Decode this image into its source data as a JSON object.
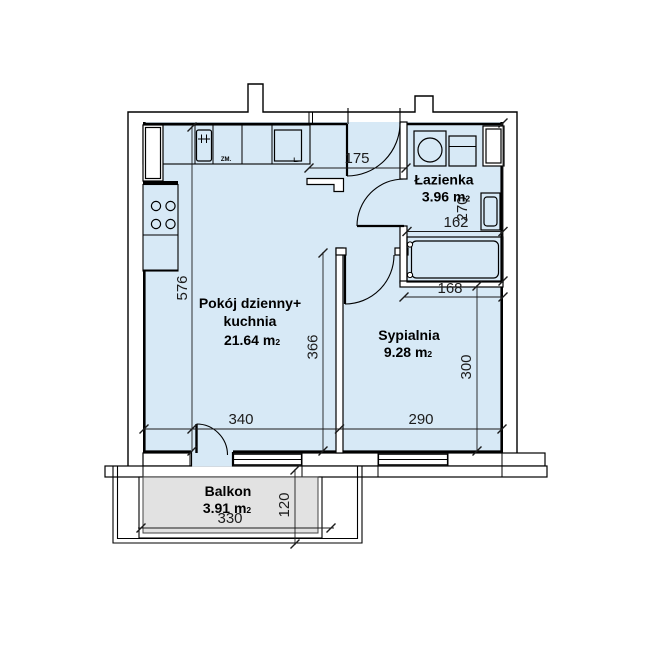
{
  "floorplan": {
    "rooms": {
      "living": {
        "name_line1": "Pokój dzienny+",
        "name_line2": "kuchnia",
        "area": "21.64 m",
        "area_sup": "2"
      },
      "bedroom": {
        "name": "Sypialnia",
        "area": "9.28 m",
        "area_sup": "2"
      },
      "bathroom": {
        "name": "Łazienka",
        "area": "3.96 m",
        "area_sup": "2"
      },
      "balcony": {
        "name": "Balkon",
        "area": "3.91 m",
        "area_sup": "2"
      }
    },
    "dimensions": {
      "hallway_width": "175",
      "bathroom_width": "162",
      "bathroom_height": "270",
      "bathtub_niche_width": "168",
      "bedroom_height": "300",
      "bedroom_width": "290",
      "living_width": "340",
      "living_height_inner": "366",
      "apartment_depth": "576",
      "balcony_width": "330",
      "balcony_depth": "120"
    },
    "kitchen": {
      "dishwasher_label": "ZM.",
      "fridge_label": "L."
    },
    "colors": {
      "room_fill": "#d7e9f6",
      "balcony_fill": "#e2e2e2",
      "wall": "#000000"
    }
  }
}
